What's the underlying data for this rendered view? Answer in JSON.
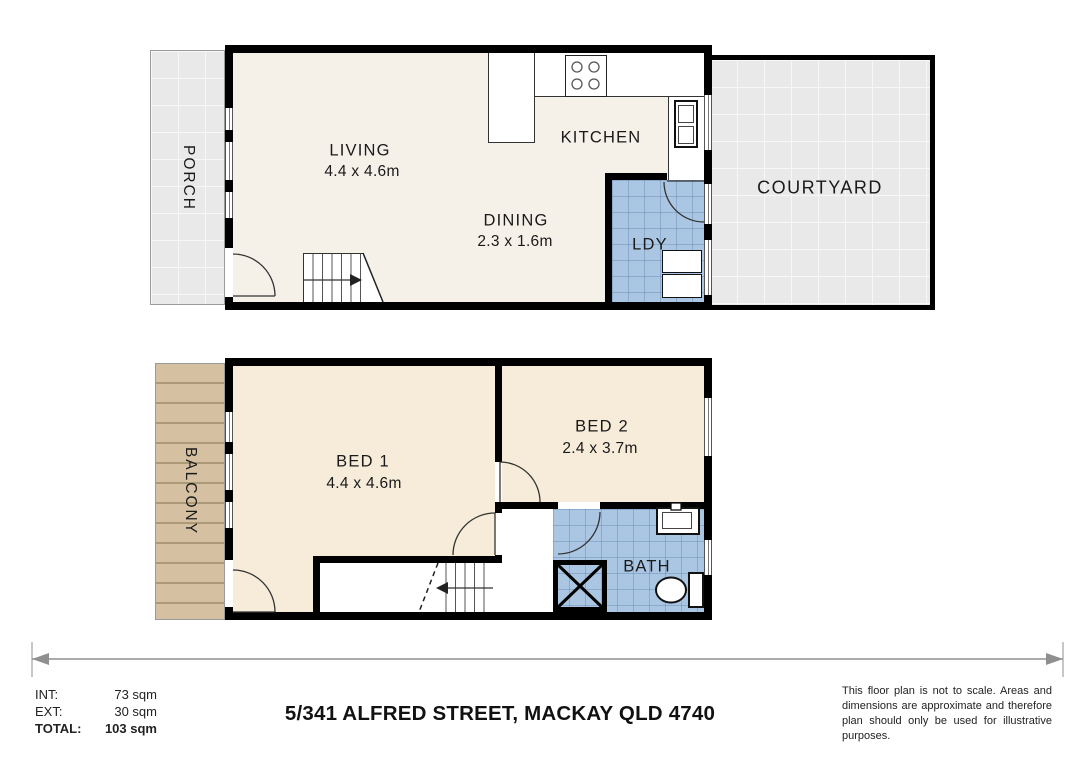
{
  "floorplan": {
    "upper": {
      "porch": {
        "label": "PORCH"
      },
      "living": {
        "label": "LIVING",
        "dims": "4.4 x 4.6m"
      },
      "kitchen": {
        "label": "KITCHEN"
      },
      "dining": {
        "label": "DINING",
        "dims": "2.3 x 1.6m"
      },
      "laundry": {
        "label": "LDY"
      },
      "courtyard": {
        "label": "COURTYARD"
      }
    },
    "lower": {
      "balcony": {
        "label": "BALCONY"
      },
      "bed1": {
        "label": "BED 1",
        "dims": "4.4 x 4.6m"
      },
      "bed2": {
        "label": "BED 2",
        "dims": "2.4 x 3.7m"
      },
      "bath": {
        "label": "BATH"
      }
    }
  },
  "footer": {
    "areas": [
      {
        "label": "INT:",
        "value": "73 sqm"
      },
      {
        "label": "EXT:",
        "value": "30 sqm"
      },
      {
        "label": "TOTAL:",
        "value": "103 sqm"
      }
    ],
    "address": "5/341 ALFRED STREET, MACKAY QLD 4740",
    "disclaimer": "This floor plan is not to scale. Areas and dimensions are approximate and therefore plan should only be used for illustrative purposes."
  },
  "palette": {
    "wall": "#000000",
    "floor_living": "#f5f1e8",
    "floor_bed": "#f6ecd9",
    "wet_area_tile": "#abc6e3",
    "paving_gray": "#e9e9e9",
    "deck_tan": "#d5c1a1",
    "dimension_line": "#8f8f8f"
  }
}
